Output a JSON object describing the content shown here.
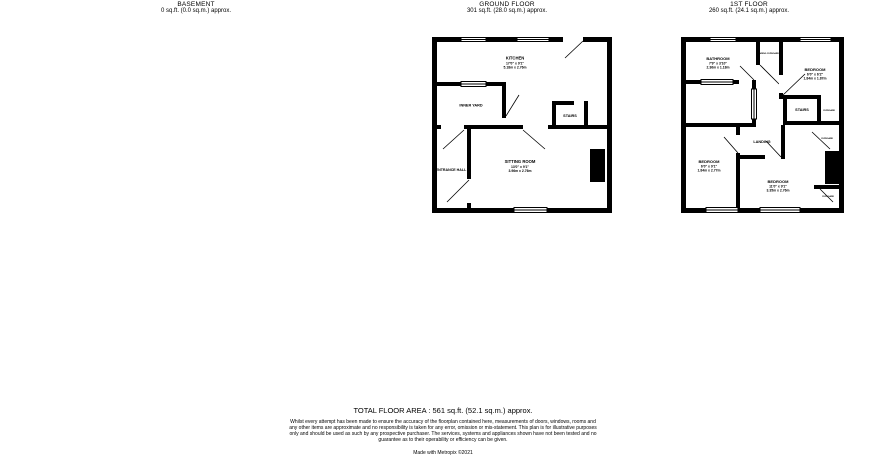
{
  "colors": {
    "wall": "#000000",
    "background": "#ffffff"
  },
  "headers": [
    {
      "title": "BASEMENT",
      "area": "0 sq.ft. (0.0 sq.m.) approx."
    },
    {
      "title": "GROUND FLOOR",
      "area": "301 sq.ft. (28.0 sq.m.) approx."
    },
    {
      "title": "1ST FLOOR",
      "area": "260 sq.ft. (24.1 sq.m.) approx."
    }
  ],
  "ground": {
    "rooms": {
      "kitchen": {
        "name": "KITCHEN",
        "imperial": "17'0\" x 9'1\"",
        "metric": "5.18m x 2.76m"
      },
      "inner_yard": {
        "name": "INNER YARD"
      },
      "stairs": {
        "name": "STAIRS"
      },
      "entrance_hall": {
        "name": "ENTRANCE HALL"
      },
      "sitting_room": {
        "name": "SITTING ROOM",
        "imperial": "13'0\" x 9'1\"",
        "metric": "3.96m x 2.76m"
      }
    }
  },
  "first": {
    "rooms": {
      "bathroom": {
        "name": "BATHROOM",
        "imperial": "7'9\" x 3'10\"",
        "metric": "2.36m x 1.18m"
      },
      "airing_cupboard": {
        "name": "AIRING CUPBOARD"
      },
      "bedroom_front": {
        "name": "BEDROOM",
        "imperial": "6'0\" x 6'2\"",
        "metric": "1.84m x 1.87m"
      },
      "stairs": {
        "name": "STAIRS"
      },
      "landing": {
        "name": "LANDING"
      },
      "bedroom_side": {
        "name": "BEDROOM",
        "imperial": "6'0\" x 9'1\"",
        "metric": "1.84m x 2.77m"
      },
      "bedroom_back": {
        "name": "BEDROOM",
        "imperial": "11'0\" x 9'1\"",
        "metric": "3.35m x 2.76m"
      },
      "cupboard": {
        "name": "CUPBOARD"
      }
    }
  },
  "footer": {
    "total": "TOTAL FLOOR AREA : 561 sq.ft. (52.1 sq.m.) approx.",
    "disclaimer": "Whilst every attempt has been made to ensure the accuracy of the floorplan contained here, measurements of doors, windows, rooms and any other items are approximate and no responsibility is taken for any error, omission or mis-statement. This plan is for illustrative purposes only and should be used as such by any prospective purchaser. The services, systems and appliances shown have not been tested and no guarantee as to their operability or efficiency can be given.",
    "made_with": "Made with Metropix ©2021"
  }
}
